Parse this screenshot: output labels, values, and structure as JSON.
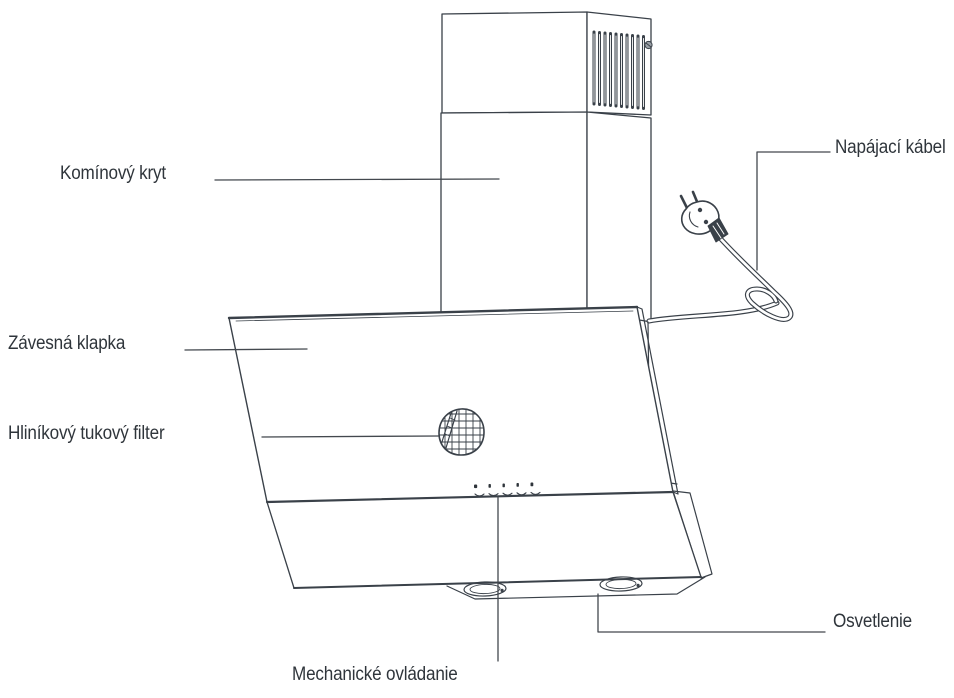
{
  "diagram": {
    "subject": "cooker-hood-parts-diagram",
    "labels": {
      "chimney": "Komínový kryt",
      "power_cable": "Napájací kábel",
      "flap": "Závesná klapka",
      "filter": "Hliníkový tukový filter",
      "lighting": "Osvetlenie",
      "controls": "Mechanické ovládanie"
    },
    "colors": {
      "line": "#3a4149",
      "text": "#2f353b",
      "background": "#ffffff"
    }
  }
}
